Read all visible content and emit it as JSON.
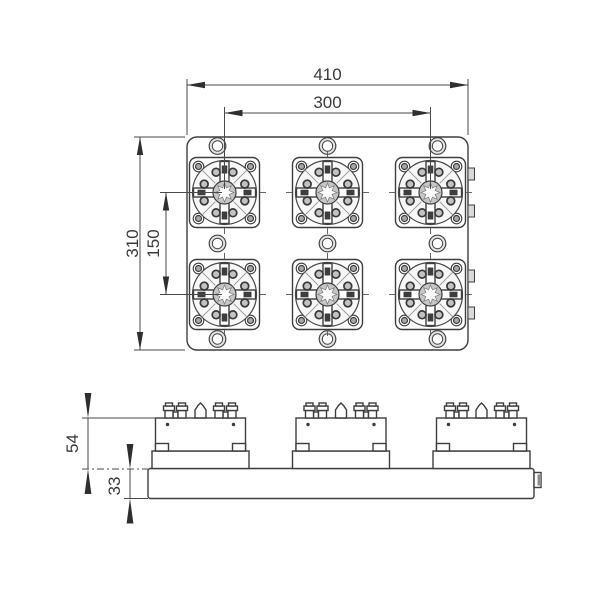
{
  "drawing": {
    "type": "technical-drawing",
    "description": "Multi-station clamping plate, top view and side view",
    "top_view": {
      "dimensions": {
        "overall_width": "410",
        "station_pitch_x": "300",
        "overall_depth": "310",
        "station_pitch_y": "150"
      },
      "stations": {
        "rows": 2,
        "columns": 3,
        "count": 6
      },
      "plate_holes": 9,
      "right_edge_tabs": 4
    },
    "side_view": {
      "dimensions": {
        "module_height": "54",
        "base_plate_thickness": "33"
      },
      "chucks": 3
    },
    "colors": {
      "line": "#3e3e3e",
      "background": "#ffffff",
      "shade": "#c6c6c6",
      "text": "#3a3a3a"
    }
  }
}
